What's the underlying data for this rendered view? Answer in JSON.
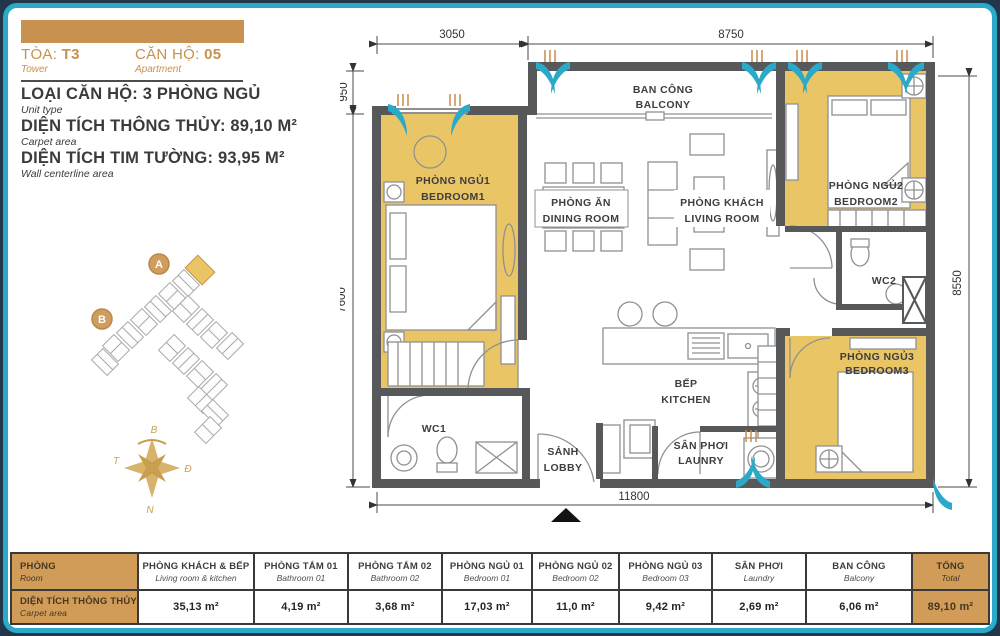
{
  "header": {
    "tower_label": "TÒA:",
    "tower_value": "T3",
    "tower_sub": "Tower",
    "apt_label": "CĂN HỘ:",
    "apt_value": "05",
    "apt_sub": "Apartment",
    "unit_type": "LOẠI CĂN HỘ: 3 PHÒNG NGỦ",
    "unit_type_sub": "Unit type",
    "carpet": "DIỆN TÍCH THÔNG THỦY: 89,10 M²",
    "carpet_sub": "Carpet area",
    "wall": "DIỆN TÍCH TIM TƯỜNG: 93,95 M²",
    "wall_sub": "Wall centerline area"
  },
  "key_plan": {
    "marker_a": "A",
    "marker_b": "B"
  },
  "compass": {
    "north": "B",
    "east": "Đ",
    "south": "N",
    "west": "T"
  },
  "plan": {
    "rooms": {
      "bedroom1": {
        "vi": "PHÒNG NGỦ1",
        "en": "BEDROOM1"
      },
      "dining": {
        "vi": "PHÒNG ĂN",
        "en": "DINING ROOM"
      },
      "living": {
        "vi": "PHÒNG KHÁCH",
        "en": "LIVING ROOM"
      },
      "balcony": {
        "vi": "BAN CÔNG",
        "en": "BALCONY"
      },
      "bedroom2": {
        "vi": "PHÒNG NGỦ2",
        "en": "BEDROOM2"
      },
      "wc2": {
        "vi": "WC2"
      },
      "bedroom3": {
        "vi": "PHÒNG NGỦ3",
        "en": "BEDROOM3"
      },
      "kitchen": {
        "vi": "BẾP",
        "en": "KITCHEN"
      },
      "laundry": {
        "vi": "SÂN PHƠI",
        "en": "LAUNRY"
      },
      "lobby": {
        "vi": "SẢNH",
        "en": "LOBBY"
      },
      "wc1": {
        "vi": "WC1"
      }
    },
    "dims": {
      "top_left": "3050",
      "top_right": "8750",
      "left_upper": "950",
      "left_lower": "7600",
      "right": "8550",
      "bottom": "11800"
    }
  },
  "table": {
    "room_header": {
      "vi": "PHÒNG",
      "en": "Room"
    },
    "row_label": {
      "vi": "DIỆN TÍCH THÔNG THỦY",
      "en": "Carpet area"
    },
    "columns": [
      {
        "vi": "PHÒNG KHÁCH & BẾP",
        "en": "Living room & kitchen",
        "value": "35,13 m²"
      },
      {
        "vi": "PHÒNG TẮM 01",
        "en": "Bathroom 01",
        "value": "4,19 m²"
      },
      {
        "vi": "PHÒNG TẮM 02",
        "en": "Bathroom 02",
        "value": "3,68 m²"
      },
      {
        "vi": "PHÒNG NGỦ 01",
        "en": "Bedroom 01",
        "value": "17,03 m²"
      },
      {
        "vi": "PHÒNG NGỦ 02",
        "en": "Bedroom 02",
        "value": "11,0 m²"
      },
      {
        "vi": "PHÒNG NGỦ 03",
        "en": "Bedroom 03",
        "value": "9,42 m²"
      },
      {
        "vi": "SÂN PHƠI",
        "en": "Laundry",
        "value": "2,69 m²"
      },
      {
        "vi": "BAN CÔNG",
        "en": "Balcony",
        "value": "6,06 m²"
      }
    ],
    "total": {
      "vi": "TỔNG",
      "en": "Total",
      "value": "89,10 m²"
    }
  },
  "colors": {
    "frame_teal": "#2aa9c9",
    "accent_orange": "#c8914f",
    "table_orange": "#d19b58",
    "room_yellow": "#e9c565",
    "wall_gray": "#57585a",
    "compass_gold": "#c9a050"
  }
}
